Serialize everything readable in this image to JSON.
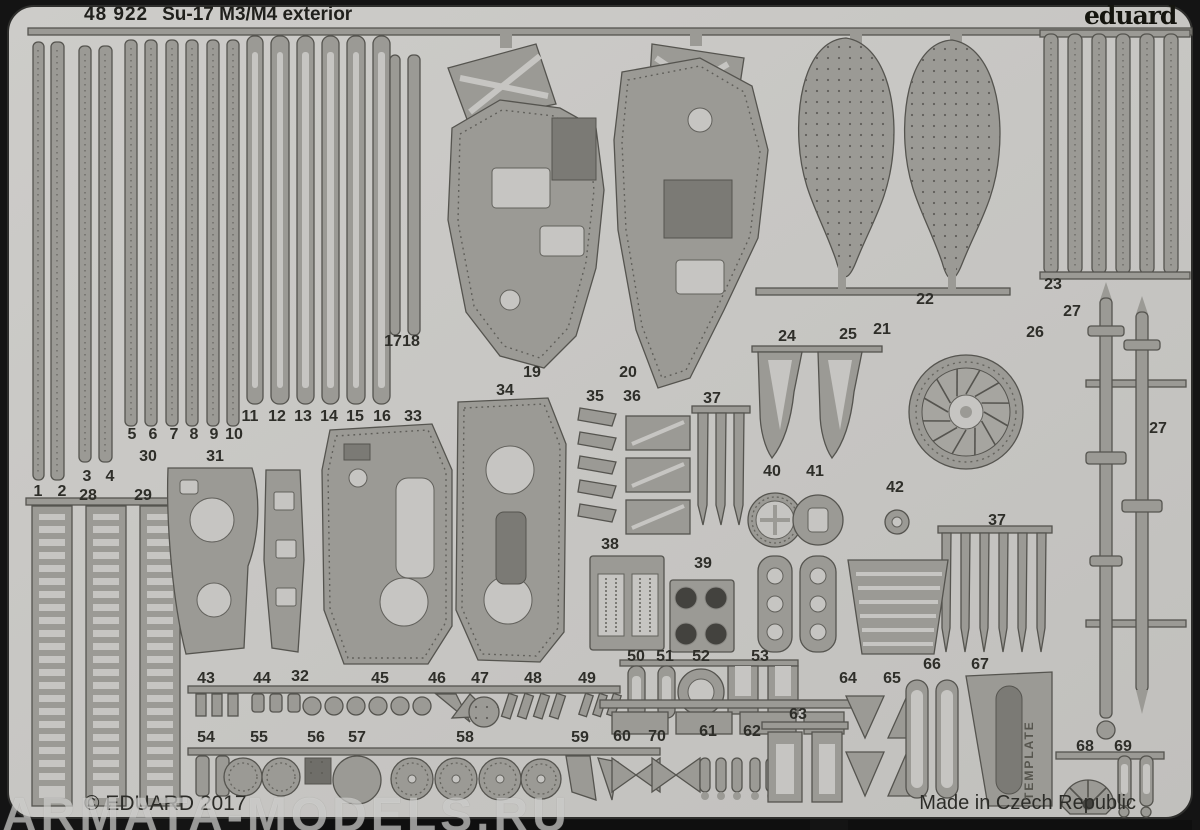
{
  "sheet": {
    "product_code": "48 922",
    "product_name": "Su-17 M3/M4 exterior",
    "brand": "eduard",
    "copyright": "© EDUARD 2017",
    "made_in": "Made in Czech Republic",
    "watermark": "ARMATA-MODELS.RU",
    "template_text": "TEMPLATE"
  },
  "colors": {
    "background": "#141414",
    "sheet": "#c8c7c4",
    "part_metal": "#9b9a95",
    "part_outline": "#55544f",
    "etched_hole": "#c6c5c2",
    "text": "#23231f",
    "watermark": "rgba(240,240,237,0.52)"
  },
  "part_labels": [
    {
      "text": "1",
      "x": 38,
      "y": 493
    },
    {
      "text": "2",
      "x": 62,
      "y": 493
    },
    {
      "text": "3",
      "x": 87,
      "y": 478
    },
    {
      "text": "4",
      "x": 110,
      "y": 478
    },
    {
      "text": "5",
      "x": 132,
      "y": 436
    },
    {
      "text": "6",
      "x": 153,
      "y": 436
    },
    {
      "text": "7",
      "x": 174,
      "y": 436
    },
    {
      "text": "8",
      "x": 194,
      "y": 436
    },
    {
      "text": "9",
      "x": 214,
      "y": 436
    },
    {
      "text": "10",
      "x": 234,
      "y": 436
    },
    {
      "text": "11",
      "x": 250,
      "y": 418
    },
    {
      "text": "12",
      "x": 277,
      "y": 418
    },
    {
      "text": "13",
      "x": 303,
      "y": 418
    },
    {
      "text": "14",
      "x": 329,
      "y": 418
    },
    {
      "text": "15",
      "x": 355,
      "y": 418
    },
    {
      "text": "16",
      "x": 382,
      "y": 418
    },
    {
      "text": "33",
      "x": 413,
      "y": 418
    },
    {
      "text": "17",
      "x": 393,
      "y": 343
    },
    {
      "text": "18",
      "x": 411,
      "y": 343
    },
    {
      "text": "19",
      "x": 532,
      "y": 374
    },
    {
      "text": "20",
      "x": 628,
      "y": 374
    },
    {
      "text": "21",
      "x": 882,
      "y": 331
    },
    {
      "text": "22",
      "x": 925,
      "y": 301
    },
    {
      "text": "23",
      "x": 1053,
      "y": 286
    },
    {
      "text": "24",
      "x": 787,
      "y": 338
    },
    {
      "text": "25",
      "x": 848,
      "y": 336
    },
    {
      "text": "26",
      "x": 1035,
      "y": 334
    },
    {
      "text": "27",
      "x": 1072,
      "y": 313
    },
    {
      "text": "27",
      "x": 1158,
      "y": 430
    },
    {
      "text": "34",
      "x": 505,
      "y": 392
    },
    {
      "text": "35",
      "x": 595,
      "y": 398
    },
    {
      "text": "36",
      "x": 632,
      "y": 398
    },
    {
      "text": "37",
      "x": 712,
      "y": 400
    },
    {
      "text": "37",
      "x": 997,
      "y": 522
    },
    {
      "text": "30",
      "x": 148,
      "y": 458
    },
    {
      "text": "31",
      "x": 215,
      "y": 458
    },
    {
      "text": "40",
      "x": 772,
      "y": 473
    },
    {
      "text": "41",
      "x": 815,
      "y": 473
    },
    {
      "text": "42",
      "x": 895,
      "y": 489
    },
    {
      "text": "28",
      "x": 88,
      "y": 497
    },
    {
      "text": "29",
      "x": 143,
      "y": 497
    },
    {
      "text": "38",
      "x": 610,
      "y": 546
    },
    {
      "text": "39",
      "x": 703,
      "y": 565
    },
    {
      "text": "43",
      "x": 206,
      "y": 680
    },
    {
      "text": "44",
      "x": 262,
      "y": 680
    },
    {
      "text": "32",
      "x": 300,
      "y": 678
    },
    {
      "text": "45",
      "x": 380,
      "y": 680
    },
    {
      "text": "46",
      "x": 437,
      "y": 680
    },
    {
      "text": "47",
      "x": 480,
      "y": 680
    },
    {
      "text": "48",
      "x": 533,
      "y": 680
    },
    {
      "text": "49",
      "x": 587,
      "y": 680
    },
    {
      "text": "50",
      "x": 636,
      "y": 658
    },
    {
      "text": "51",
      "x": 665,
      "y": 658
    },
    {
      "text": "52",
      "x": 701,
      "y": 658
    },
    {
      "text": "53",
      "x": 760,
      "y": 658
    },
    {
      "text": "64",
      "x": 848,
      "y": 680
    },
    {
      "text": "65",
      "x": 892,
      "y": 680
    },
    {
      "text": "66",
      "x": 932,
      "y": 666
    },
    {
      "text": "67",
      "x": 980,
      "y": 666
    },
    {
      "text": "63",
      "x": 798,
      "y": 716
    },
    {
      "text": "60",
      "x": 622,
      "y": 738
    },
    {
      "text": "70",
      "x": 657,
      "y": 738
    },
    {
      "text": "61",
      "x": 708,
      "y": 733
    },
    {
      "text": "62",
      "x": 752,
      "y": 733
    },
    {
      "text": "54",
      "x": 206,
      "y": 739
    },
    {
      "text": "55",
      "x": 259,
      "y": 739
    },
    {
      "text": "56",
      "x": 316,
      "y": 739
    },
    {
      "text": "57",
      "x": 357,
      "y": 739
    },
    {
      "text": "58",
      "x": 465,
      "y": 739
    },
    {
      "text": "59",
      "x": 580,
      "y": 739
    },
    {
      "text": "68",
      "x": 1085,
      "y": 748
    },
    {
      "text": "69",
      "x": 1123,
      "y": 748
    }
  ]
}
